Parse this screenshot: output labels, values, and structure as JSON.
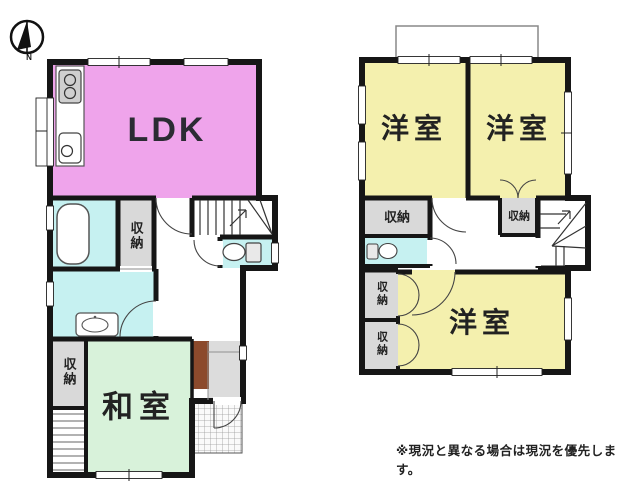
{
  "compass": {
    "label": "N"
  },
  "floor1": {
    "ldk_label": "LDK",
    "washitsu_label": "和室",
    "storage_bath_label": "収納",
    "storage_washitsu_label": "収納"
  },
  "floor2": {
    "bedroom1_label": "洋室",
    "bedroom2_label": "洋室",
    "bedroom3_label": "洋室",
    "storage_hall_label": "収納",
    "storage_stairs_label": "収納",
    "closet_top_label": "収納",
    "closet_bottom_label": "収納"
  },
  "footer": {
    "disclaimer": "※現況と異なる場合は現況を優先します。"
  },
  "colors": {
    "ldk": "#efa4eb",
    "japanese_room": "#d8f2da",
    "western_room": "#f4f0ae",
    "wet_area": "#c6f1f1",
    "storage": "#d9d9d9",
    "entrance": "#dcdcdc",
    "cabinet": "#8c4a2c",
    "wall": "#161616",
    "background": "#ffffff"
  }
}
